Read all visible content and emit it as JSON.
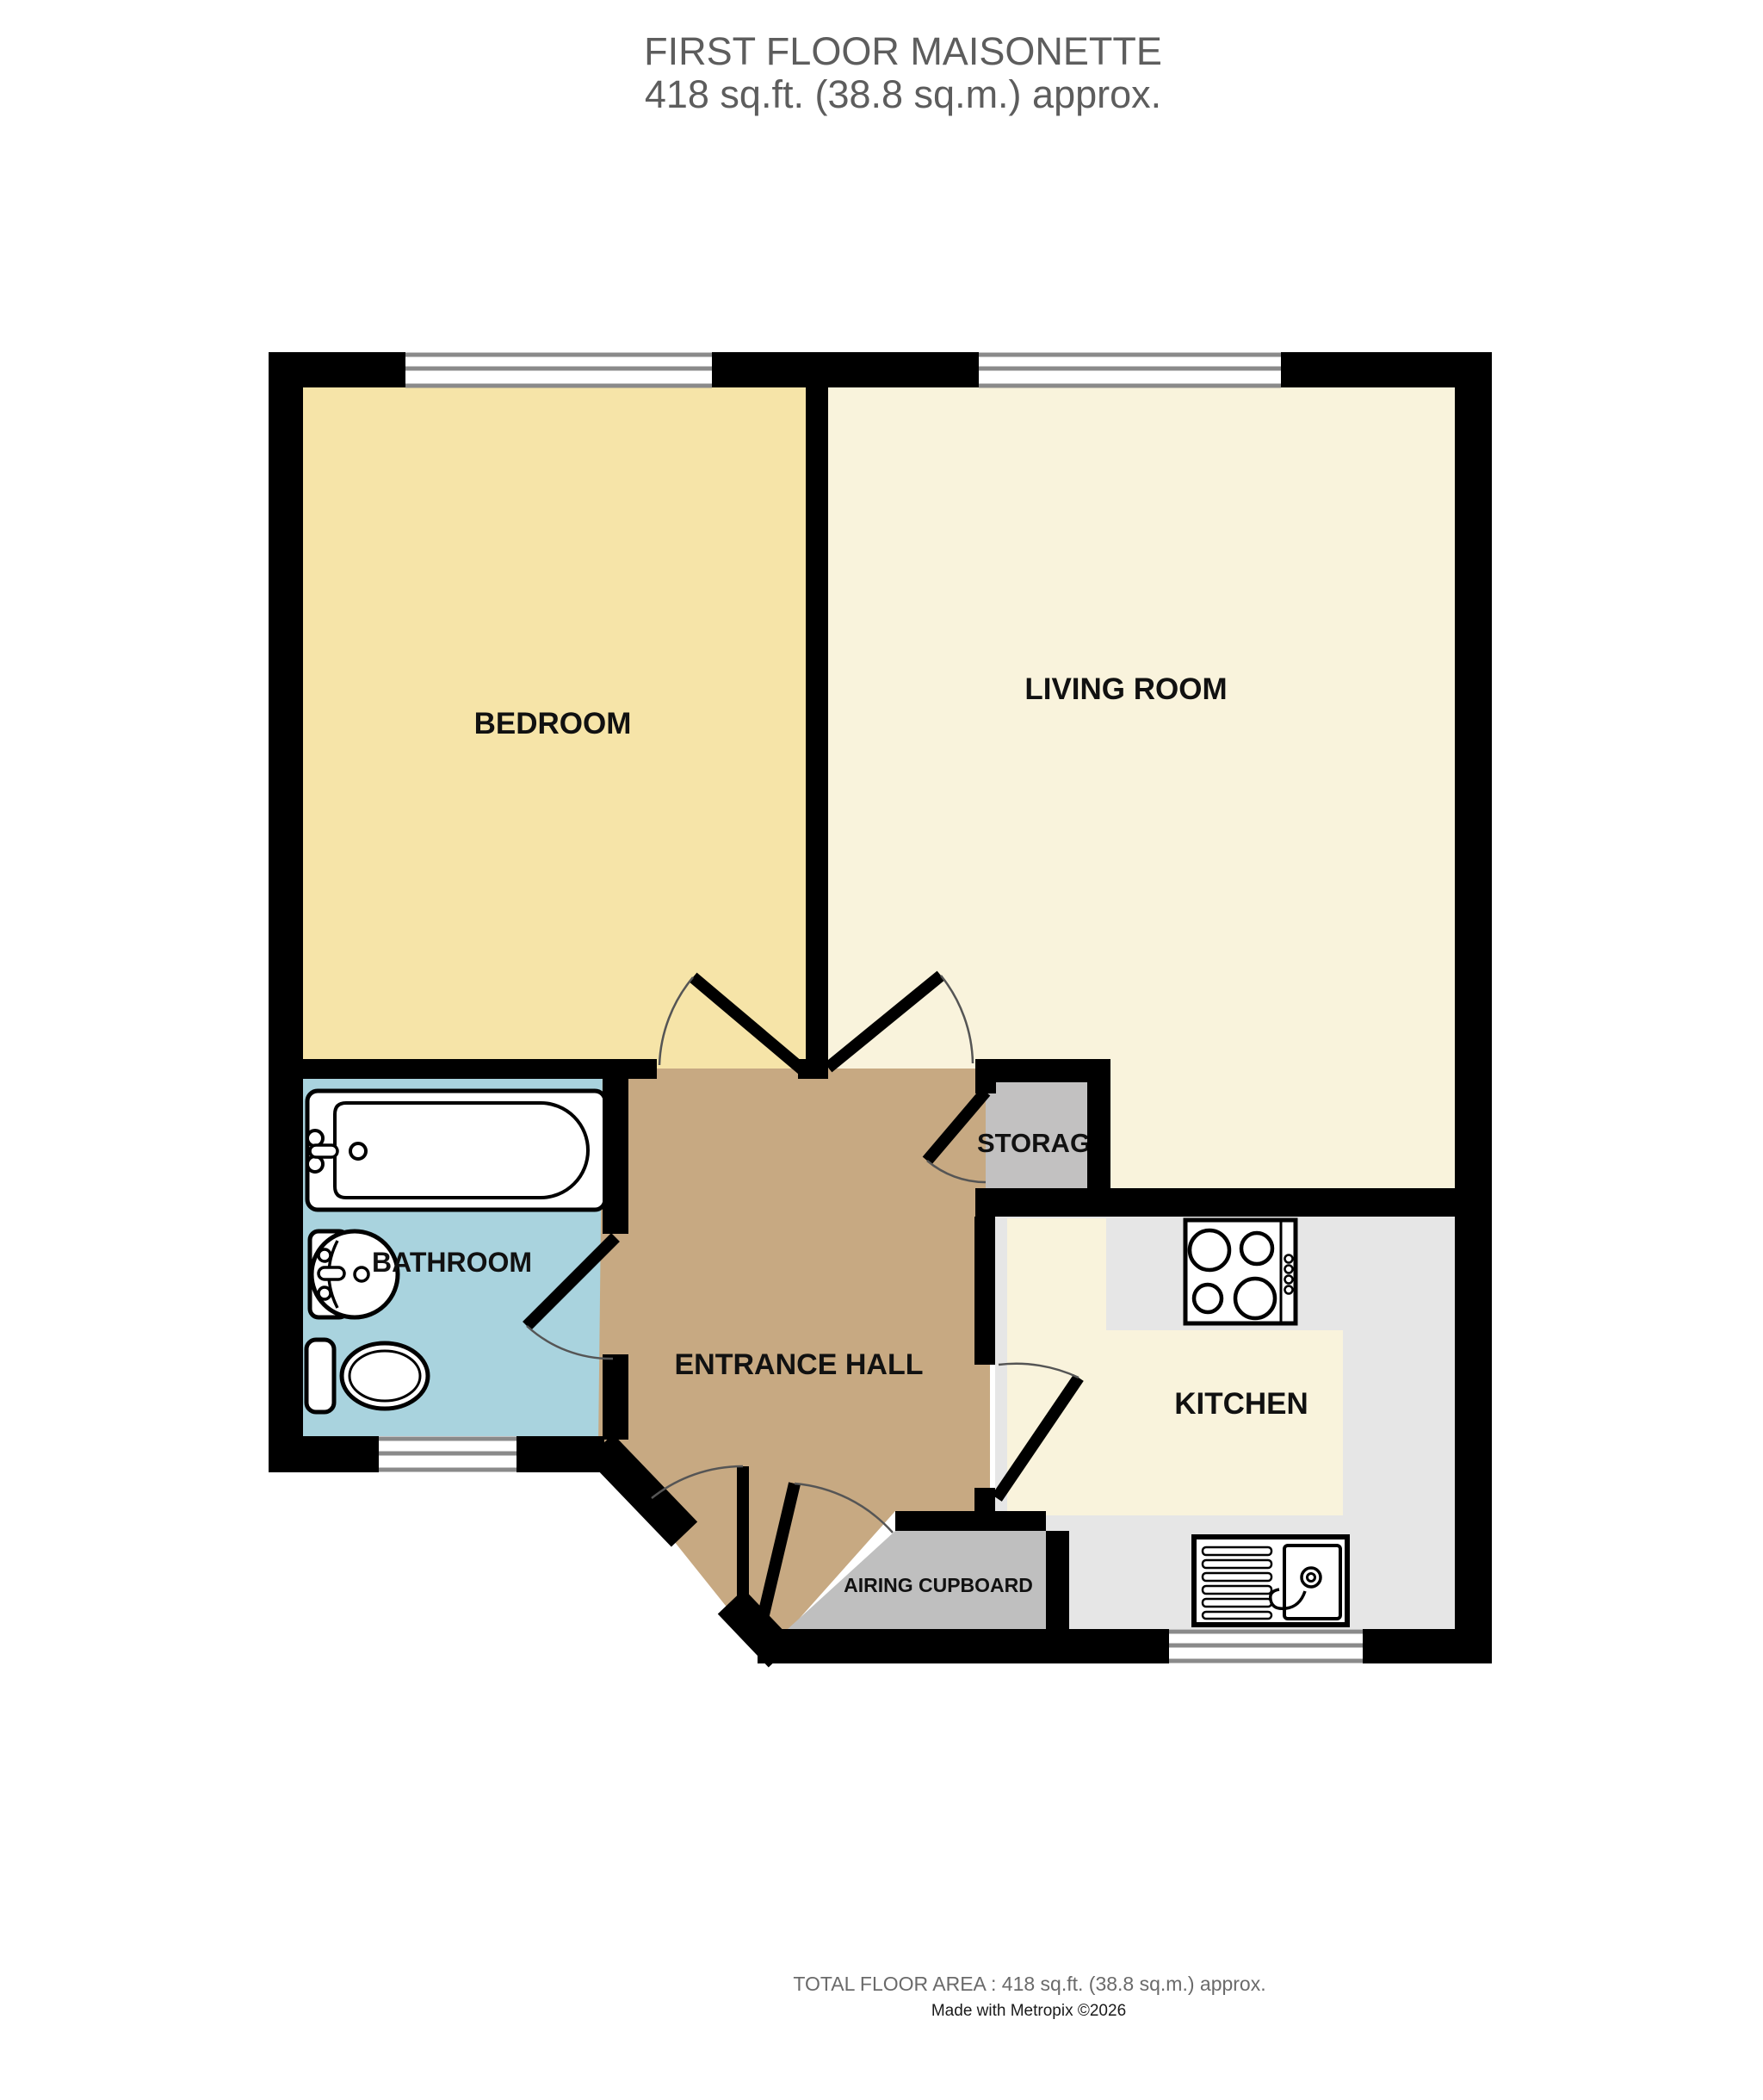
{
  "title": {
    "line1": "FIRST FLOOR MAISONETTE",
    "line2": "418 sq.ft. (38.8 sq.m.) approx."
  },
  "rooms": {
    "bedroom": {
      "label": "BEDROOM"
    },
    "living_room": {
      "label": "LIVING ROOM"
    },
    "bathroom": {
      "label": "BATHROOM"
    },
    "entrance_hall": {
      "label": "ENTRANCE HALL"
    },
    "kitchen": {
      "label": "KITCHEN"
    },
    "storage": {
      "label": "STORAGE"
    },
    "airing_cupboard": {
      "label": "AIRING CUPBOARD"
    }
  },
  "fixtures": {
    "bath": "bath-icon",
    "pedestal_basin": "basin-icon",
    "toilet": "toilet-icon",
    "hob": "hob-icon",
    "kitchen_sink": "sink-drainer-icon"
  },
  "footer": {
    "total_area": "TOTAL FLOOR AREA : 418 sq.ft. (38.8 sq.m.) approx.",
    "credit": "Made with Metropix ©2026"
  },
  "colors": {
    "bedroom": "#f6e4a8",
    "living_room": "#f9f3dc",
    "bathroom": "#a9d3de",
    "hall": "#c7a982",
    "storage": "#c2c1c1",
    "kitchen_floor": "#f9f3dc",
    "worktop": "#e6e6e6",
    "cupboard": "#bfbfbf",
    "wall": "#000000",
    "fixture_line": "#000000",
    "window_line": "#8a8a8a",
    "door_arc": "#555555",
    "label": "#111111",
    "title_text": "#5d5d5d",
    "footer_area": "#6a6a6a",
    "footer_credit": "#1a1a1a"
  }
}
